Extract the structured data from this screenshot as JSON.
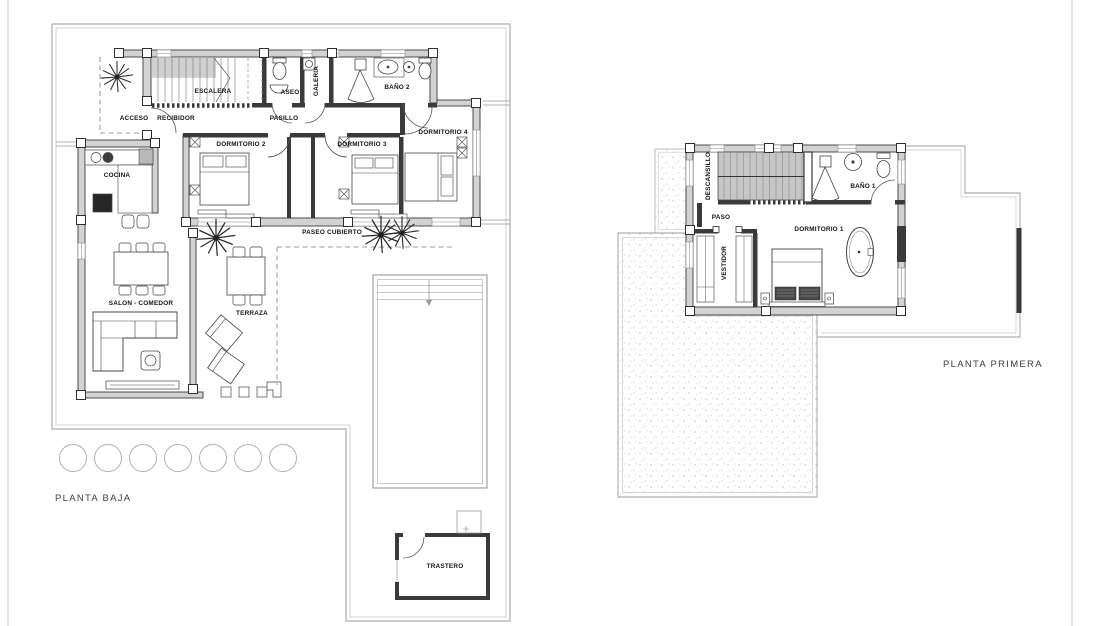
{
  "floors": [
    {
      "id": "planta-baja",
      "title": "PLANTA BAJA",
      "rooms": [
        {
          "label": "ESCALERA"
        },
        {
          "label": "ASEO"
        },
        {
          "label": "GALERIA"
        },
        {
          "label": "BAÑO 2"
        },
        {
          "label": "ACCESO"
        },
        {
          "label": "RECIBIDOR"
        },
        {
          "label": "PASILLO"
        },
        {
          "label": "DORMITORIO 2"
        },
        {
          "label": "DORMITORIO 3"
        },
        {
          "label": "DORMITORIO 4"
        },
        {
          "label": "COCINA"
        },
        {
          "label": "SALON - COMEDOR"
        },
        {
          "label": "TERRAZA"
        },
        {
          "label": "PASEO CUBIERTO"
        },
        {
          "label": "TRASTERO"
        }
      ]
    },
    {
      "id": "planta-primera",
      "title": "PLANTA PRIMERA",
      "rooms": [
        {
          "label": "DESCANSILLO"
        },
        {
          "label": "PASO"
        },
        {
          "label": "BAÑO 1"
        },
        {
          "label": "DORMITORIO 1"
        },
        {
          "label": "VESTIDOR"
        }
      ]
    }
  ],
  "palette": {
    "background": "#ffffff",
    "wall_outline": "#3a3a3a",
    "wall_fill": "#d3d3d3",
    "boundary_line": "#9b9b9b",
    "stipple_dot": "#cfcfcf",
    "label_text": "#151515",
    "title_text": "#3f3f3f"
  }
}
